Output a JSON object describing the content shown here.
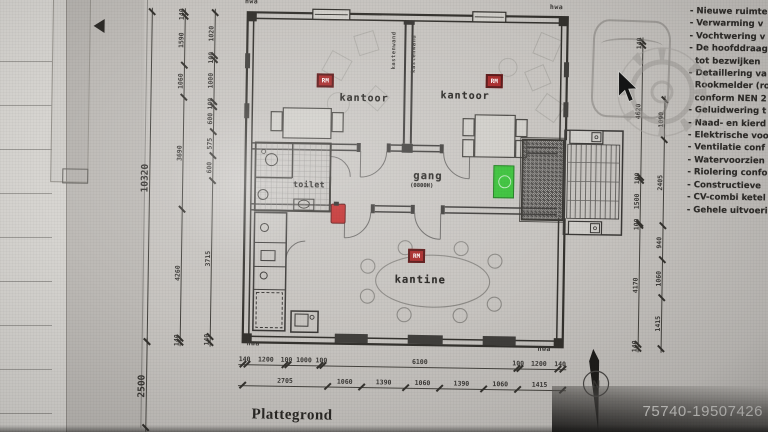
{
  "photo": {
    "watermark_id": "75740-19507426"
  },
  "titleblock": {
    "title": "Plattegrond"
  },
  "compass": {
    "north": "N"
  },
  "rooms": {
    "kantoor_left": "kantoor",
    "kantoor_right": "kantoor",
    "gang": "gang",
    "gang_note": "(0800H)",
    "toilet": "toilet",
    "kantine": "kantine"
  },
  "wall_labels": {
    "hwa": "hwa",
    "kastenwand": "kastenwand",
    "rm": "RM"
  },
  "dimensions": {
    "overall_height": [
      "10320"
    ],
    "front_strip": [
      "2500"
    ],
    "top_width": [
      "140",
      "1200",
      "100",
      "1000",
      "100",
      "6100",
      "100",
      "1200",
      "140"
    ],
    "bottom_width": [
      "2705",
      "1060",
      "1390",
      "1060",
      "1390",
      "1060",
      "1415"
    ],
    "left_outer": [
      "140",
      "1590",
      "1060",
      "3690",
      "4260",
      "140"
    ],
    "left_inner": [
      "1020",
      "100",
      "1000",
      "100",
      "600",
      "575",
      "600",
      "3715",
      "140"
    ],
    "right_inner": [
      "140",
      "4620",
      "100",
      "1500",
      "100",
      "4170",
      "140"
    ],
    "right_outer": [
      "1090",
      "2405",
      "940",
      "1060",
      "1415"
    ]
  },
  "notes": [
    "- Nieuwe ruimte",
    "- Verwarming v",
    "- Vochtwering v",
    "- De hoofddraag",
    "  tot bezwijken",
    "- Detaillering va",
    "  Rookmelder (ro",
    "  conform NEN 2",
    "- Geluidwering t",
    "- Naad- en kierd",
    "- Elektrische voo",
    "- Ventilatie conf",
    "- Watervoorzien",
    "- Riolering confo",
    "- Constructieve",
    "- CV-combi ketel",
    "- Gehele uitvoeri"
  ]
}
